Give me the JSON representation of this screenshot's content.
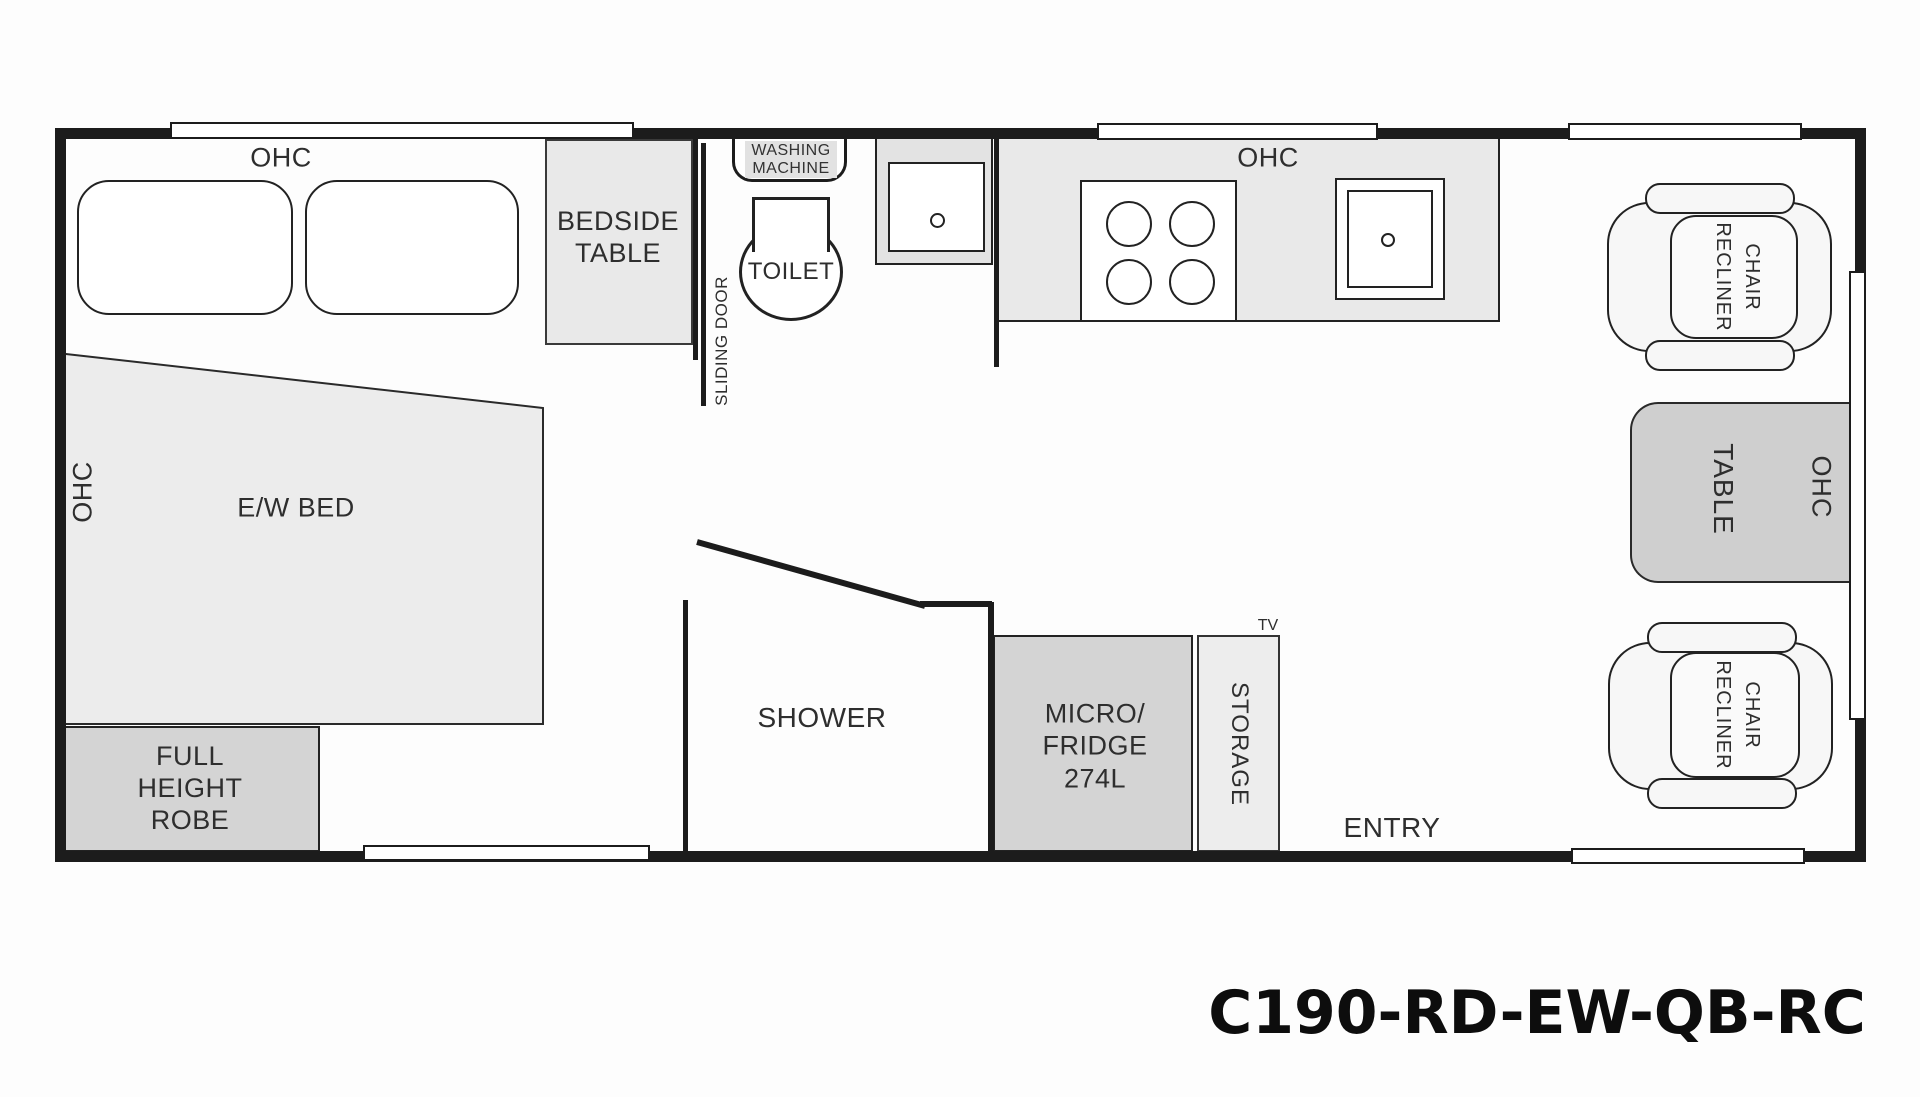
{
  "plan": {
    "model_code": "C190-RD-EW-QB-RC",
    "bedroom": {
      "ohc_top": "OHC",
      "ohc_side": "OHC",
      "bed_label": "E/W BED",
      "bedside_table": [
        "BEDSIDE",
        "TABLE"
      ],
      "robe": [
        "FULL",
        "HEIGHT",
        "ROBE"
      ],
      "sliding_door": "SLIDING DOOR"
    },
    "bathroom": {
      "washing_machine": [
        "WASHING",
        "MACHINE"
      ],
      "toilet": "TOILET",
      "shower": "SHOWER"
    },
    "kitchen": {
      "ohc": "OHC",
      "micro_fridge": [
        "MICRO/",
        "FRIDGE",
        "274L"
      ],
      "storage": "STORAGE",
      "tv": "TV"
    },
    "lounge": {
      "recliner_front": [
        "RECLINER",
        "CHAIR"
      ],
      "recliner_rear": [
        "RECLINER",
        "CHAIR"
      ],
      "table": "TABLE",
      "ohc": "OHC",
      "entry": "ENTRY"
    }
  }
}
